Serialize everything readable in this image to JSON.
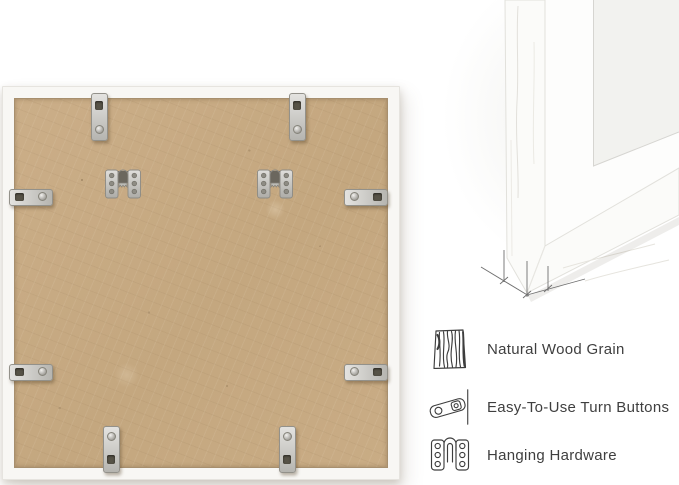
{
  "dimension_labels": {
    "depth": "0.7\"",
    "face_width": "0.45\""
  },
  "features": [
    {
      "icon": "wood-grain-icon",
      "label": "Natural Wood Grain"
    },
    {
      "icon": "turn-button-icon",
      "label": "Easy-To-Use Turn Buttons"
    },
    {
      "icon": "hanging-hardware-icon",
      "label": "Hanging Hardware"
    }
  ],
  "colors": {
    "background": "#ffffff",
    "mdf_backing": "#c7aa83",
    "frame_white": "#f8f7f4",
    "metal_hardware": "#c4c3bf",
    "text": "#3f3f3f",
    "dimension_lines": "#6f6f6f"
  }
}
